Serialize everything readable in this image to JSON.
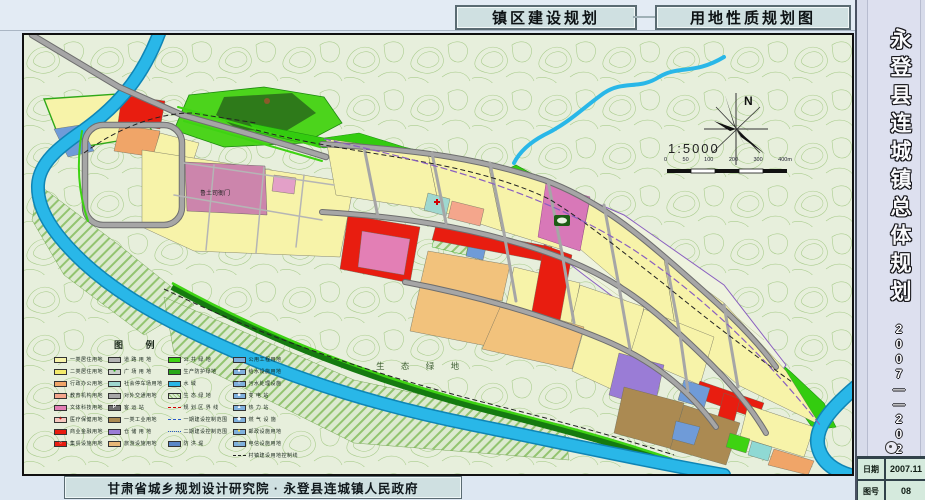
{
  "header": {
    "title1": "镇区建设规划",
    "title2": "用地性质规划图"
  },
  "sidebar": {
    "title": "永登县连城镇总体规划",
    "years": "2007——2020",
    "date_label": "日期",
    "date_value": "2007.11",
    "sheet_label": "图号",
    "sheet_value": "08"
  },
  "footer": {
    "credit": "甘肃省城乡规划设计研究院 · 永登县连城镇人民政府"
  },
  "map": {
    "north_label": "N",
    "scale_text": "1:5000",
    "scale_labels": [
      "0",
      "50",
      "100",
      "200",
      "300",
      "400m"
    ],
    "eco_label": "生 态 绿 地",
    "heritage_label": "鲁土司衙门",
    "colors": {
      "water": "#29b7e8",
      "road": "#a6a6a6",
      "public_green": "#33cc0f",
      "background": "#e7efdc"
    },
    "legend": {
      "title": "图  例",
      "columns": [
        [
          {
            "label": "一类居住用地",
            "swatch": {
              "type": "fill",
              "color": "#f7f3a9"
            }
          },
          {
            "label": "二类居住用地",
            "swatch": {
              "type": "fill",
              "color": "#f3ea6b"
            }
          },
          {
            "label": "行政办公用地",
            "swatch": {
              "type": "fill",
              "color": "#f0a568"
            }
          },
          {
            "label": "教育机构用地",
            "swatch": {
              "type": "fill",
              "color": "#f4a68c"
            }
          },
          {
            "label": "文体科技用地",
            "swatch": {
              "type": "fill",
              "color": "#e37fb5"
            }
          },
          {
            "label": "医疗保健用地",
            "swatch": {
              "type": "fill",
              "color": "#f7c9c0",
              "glyph": "+",
              "glyphColor": "#d00000"
            }
          },
          {
            "label": "商业金融用地",
            "swatch": {
              "type": "fill",
              "color": "#e81d10"
            }
          },
          {
            "label": "集贸设施用地",
            "swatch": {
              "type": "fill",
              "color": "#e81d10",
              "glyph": "○",
              "glyphColor": "#ffffff"
            }
          }
        ],
        [
          {
            "label": "道 路 用 地",
            "swatch": {
              "type": "fill",
              "color": "#b3b3b3"
            }
          },
          {
            "label": "广 场 用 地",
            "swatch": {
              "type": "fill",
              "color": "#c9cdc9",
              "glyph": "●",
              "glyphColor": "#2aa818"
            }
          },
          {
            "label": "社会停车场用地",
            "swatch": {
              "type": "fill",
              "color": "#9fd8cf"
            }
          },
          {
            "label": "对外交通用地",
            "swatch": {
              "type": "fill",
              "color": "#a8a8a8"
            }
          },
          {
            "label": "客  运  站",
            "swatch": {
              "type": "fill",
              "color": "#707070",
              "glyph": "P",
              "glyphColor": "#ffffff"
            }
          },
          {
            "label": "一类工业用地",
            "swatch": {
              "type": "fill",
              "color": "#ab8a52"
            }
          },
          {
            "label": "仓 储 用 地",
            "swatch": {
              "type": "fill",
              "color": "#9a7cd6"
            }
          },
          {
            "label": "旅游设施用地",
            "swatch": {
              "type": "fill",
              "color": "#e8b878"
            }
          }
        ],
        [
          {
            "label": "公 共 绿 地",
            "swatch": {
              "type": "fill",
              "color": "#3ed312"
            }
          },
          {
            "label": "生产防护绿地",
            "swatch": {
              "type": "fill",
              "color": "#28a818"
            }
          },
          {
            "label": "水      域",
            "swatch": {
              "type": "fill",
              "color": "#29b7e8"
            }
          },
          {
            "label": "生 态 绿 地",
            "swatch": {
              "type": "hatch"
            }
          },
          {
            "label": "规 划 区 界 线",
            "swatch": {
              "type": "line",
              "style": "red-dash"
            }
          },
          {
            "label": "一期建设控制范围",
            "swatch": {
              "type": "line",
              "style": "blue-dash"
            }
          },
          {
            "label": "二期建设控制范围",
            "swatch": {
              "type": "line",
              "style": "blue-dashdot"
            }
          },
          {
            "label": "防  洪  堤",
            "swatch": {
              "type": "fill",
              "color": "#5a87c8"
            }
          }
        ],
        [
          {
            "label": "公用工程用地",
            "swatch": {
              "type": "fill",
              "color": "#7fb0dd"
            }
          },
          {
            "label": "给水设施用地",
            "swatch": {
              "type": "fill",
              "color": "#7fb0dd",
              "glyph": "●",
              "glyphColor": "#ffffff"
            }
          },
          {
            "label": "污水处理设施",
            "swatch": {
              "type": "fill",
              "color": "#7fb0dd",
              "glyph": "○",
              "glyphColor": "#ffffff"
            }
          },
          {
            "label": "变  电  站",
            "swatch": {
              "type": "fill",
              "color": "#7fb0dd",
              "glyph": "■",
              "glyphColor": "#ffffff"
            }
          },
          {
            "label": "热  力  站",
            "swatch": {
              "type": "fill",
              "color": "#7fb0dd",
              "glyph": "▲",
              "glyphColor": "#ffffff"
            }
          },
          {
            "label": "燃 气 设 施",
            "swatch": {
              "type": "fill",
              "color": "#7fb0dd",
              "glyph": "◆",
              "glyphColor": "#ffffff"
            }
          },
          {
            "label": "邮政设施用地",
            "swatch": {
              "type": "fill",
              "color": "#7fb0dd",
              "glyph": "●",
              "glyphColor": "#ffe24a"
            }
          },
          {
            "label": "电信设施用地",
            "swatch": {
              "type": "fill",
              "color": "#7fb0dd",
              "glyph": "○",
              "glyphColor": "#ffe24a"
            }
          },
          {
            "label": "村镇建设用地控制线",
            "swatch": {
              "type": "line",
              "style": "black-dash"
            }
          }
        ]
      ]
    }
  }
}
